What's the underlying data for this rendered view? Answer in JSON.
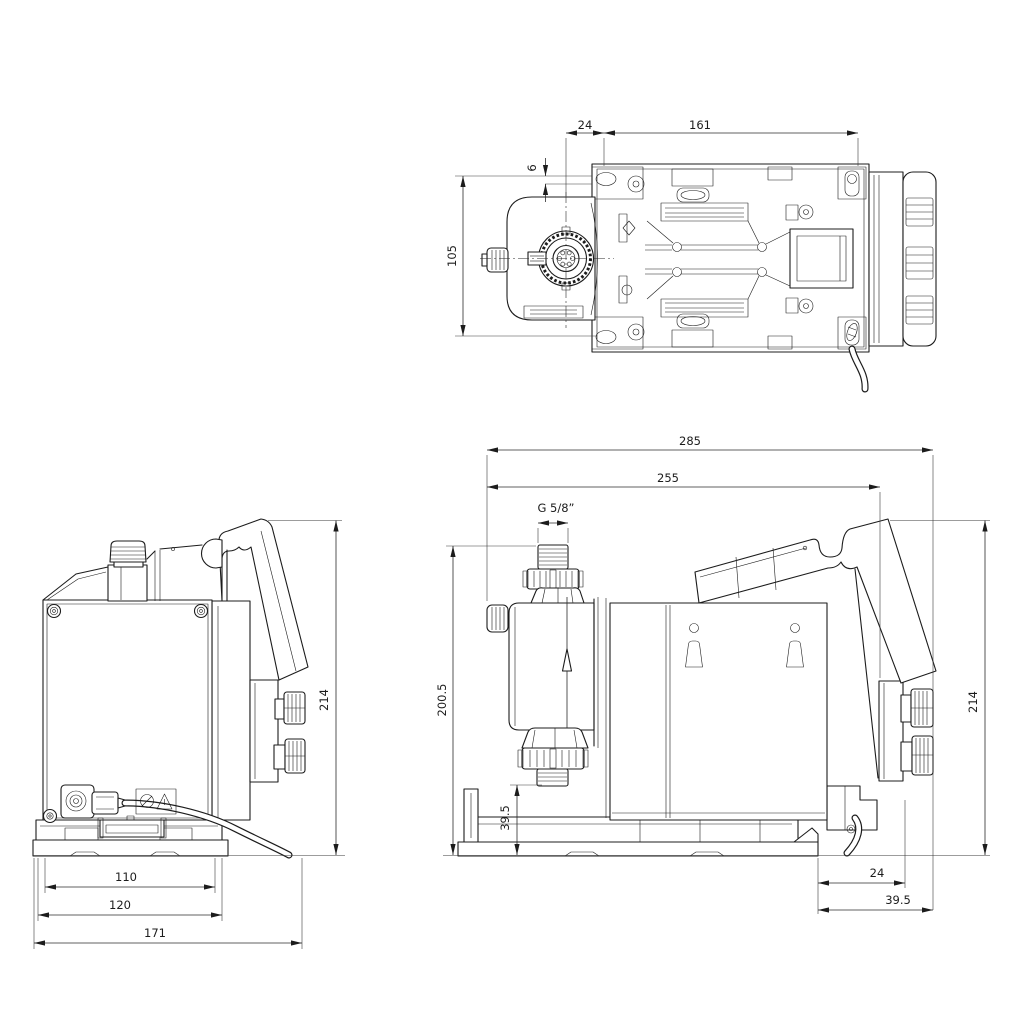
{
  "page": {
    "background": "#ffffff",
    "line_color": "#1c1c1c",
    "description": "Dimensional drawing of a dosing pump, three orthographic views"
  },
  "views": {
    "top": {
      "name": "top view",
      "dims": {
        "head_to_hole": "24",
        "hole_spacing_x": "161",
        "edge_to_hole": "6",
        "hole_spacing_y": "105"
      }
    },
    "front": {
      "name": "front view",
      "dims": {
        "overall_height": "214",
        "base_slot": "110",
        "base_width": "120",
        "overall_depth": "171"
      }
    },
    "side": {
      "name": "side view",
      "dims": {
        "overall_length": "285",
        "body_length": "255",
        "connection_thread": "G 5/8”",
        "connector_height": "200.5",
        "connector_clearance": "39.5",
        "overall_height": "214",
        "knob_offset": "24",
        "knob_overhang": "39.5"
      }
    }
  }
}
